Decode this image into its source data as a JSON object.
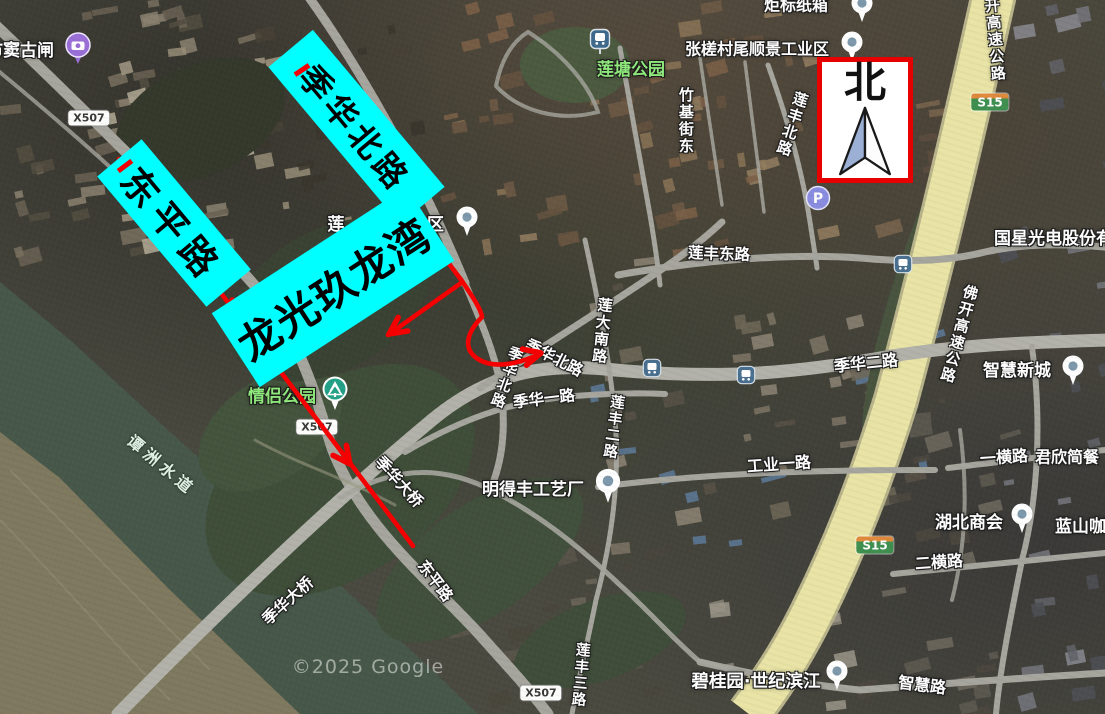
{
  "colors": {
    "annotation_cyan": "#00ffff",
    "annotation_red": "#f40000",
    "north_border_red": "#e60000",
    "highway_yellow": "#e9e4a6",
    "road_gray": "#a6a69e",
    "river_green": "#47584a",
    "park_label_green": "#8fe97c",
    "s15_badge_green": "#3f9050",
    "s15_badge_orange": "#e08a3c"
  },
  "north_box": {
    "label": "北"
  },
  "annotations": {
    "boxes": [
      {
        "id": "dongping-road-callout",
        "text": "东平路",
        "x": 174,
        "y": 223,
        "w": 170,
        "h": 58,
        "r": 50,
        "fs": 37,
        "ls": 8
      },
      {
        "id": "jihua-north-road-callout",
        "text": "季华北路",
        "x": 356,
        "y": 127,
        "w": 205,
        "h": 58,
        "r": 50,
        "fs": 33,
        "ls": 5
      },
      {
        "id": "longguang-jiulongwan-callout",
        "text": "龙光玖龙湾",
        "x": 333,
        "y": 287,
        "w": 232,
        "h": 88,
        "r": -33,
        "fs": 42,
        "ls": 2
      }
    ]
  },
  "red": {
    "paths": [
      "M 119 159 L 413 546",
      "M 297 62 L 462 281 C 472 296 481 309 482 317 C 467 332 462 349 478 359 C 492 368 513 365 533 357 L 541 353",
      "M 461 283 L 388 335"
    ],
    "arrows": [
      {
        "x": 232,
        "y": 300,
        "a": -127
      },
      {
        "x": 350,
        "y": 464,
        "a": 53
      },
      {
        "x": 404,
        "y": 198,
        "a": 56
      },
      {
        "x": 541,
        "y": 353,
        "a": -14
      },
      {
        "x": 389,
        "y": 334,
        "a": 145
      }
    ],
    "ticks": [
      {
        "x": 125,
        "y": 166,
        "r": 53
      },
      {
        "x": 302,
        "y": 70,
        "r": 56
      }
    ]
  },
  "map": {
    "labels": [
      {
        "id": "shuidou-sluice",
        "t": "市窦古闸",
        "x": 20,
        "y": 52,
        "fs": 17,
        "cls": "place"
      },
      {
        "id": "liantang-park",
        "t": "莲塘公园",
        "x": 631,
        "y": 71,
        "fs": 17,
        "cls": "park"
      },
      {
        "id": "zhangcha-shunjing-industrial-zone",
        "t": "张槎村尾顺景工业区",
        "x": 757,
        "y": 50,
        "fs": 16,
        "cls": "place"
      },
      {
        "id": "jubiao-paper-box",
        "t": "炬标纸箱",
        "x": 796,
        "y": 6,
        "fs": 16,
        "cls": "place"
      },
      {
        "id": "zhuji-street-east",
        "t": "竹基街东",
        "x": 685,
        "y": 121,
        "fs": 15,
        "cls": "road",
        "v": 1
      },
      {
        "id": "lianfeng-north-road",
        "t": "莲丰北路",
        "x": 791,
        "y": 124,
        "fs": 15,
        "cls": "road",
        "v": 1,
        "r": 18
      },
      {
        "id": "kai-expressway",
        "t": "开高速公路",
        "x": 994,
        "y": 40,
        "fs": 15,
        "cls": "road",
        "v": 1,
        "r": -5
      },
      {
        "id": "lianfeng-east-road",
        "t": "莲丰东路",
        "x": 719,
        "y": 254,
        "fs": 15.5,
        "cls": "road",
        "r": 2
      },
      {
        "id": "guoxing-optoelectronics",
        "t": "国星光电股份有限",
        "x": 1062,
        "y": 240,
        "fs": 17,
        "cls": "place"
      },
      {
        "id": "fokai-expressway",
        "t": "佛开高速公路",
        "x": 958,
        "y": 334,
        "fs": 15,
        "cls": "road",
        "v": 1,
        "r": 15
      },
      {
        "id": "lianda-south-road",
        "t": "莲大南路",
        "x": 601,
        "y": 331,
        "fs": 15,
        "cls": "road",
        "v": 1,
        "r": 6
      },
      {
        "id": "lian-fragment",
        "t": "莲",
        "x": 336,
        "y": 226,
        "fs": 17,
        "cls": "place"
      },
      {
        "id": "industrial-dev-zone-fragment",
        "t": "业开发区",
        "x": 410,
        "y": 226,
        "fs": 17,
        "cls": "place"
      },
      {
        "id": "jihua-north-road-ne",
        "t": "季华北路",
        "x": 554,
        "y": 358,
        "fs": 15.5,
        "cls": "road",
        "r": 27
      },
      {
        "id": "jihua-north-road-s",
        "t": "季华北路",
        "x": 505,
        "y": 377,
        "fs": 14.5,
        "cls": "road",
        "v": 1,
        "r": 20
      },
      {
        "id": "jihua-1st-road",
        "t": "季华一路",
        "x": 544,
        "y": 399,
        "fs": 15.5,
        "cls": "road",
        "r": -7
      },
      {
        "id": "lianfeng-2nd-road",
        "t": "莲丰二路",
        "x": 612,
        "y": 427,
        "fs": 14.5,
        "cls": "road",
        "v": 1,
        "r": 8
      },
      {
        "id": "jihua-2nd-road",
        "t": "季华二路",
        "x": 866,
        "y": 364,
        "fs": 16,
        "cls": "road",
        "r": -6
      },
      {
        "id": "gongye-1st-road",
        "t": "工业一路",
        "x": 779,
        "y": 465,
        "fs": 16,
        "cls": "road",
        "r": -4
      },
      {
        "id": "mingdefeng-craft-factory",
        "t": "明得丰工艺厂",
        "x": 533,
        "y": 491,
        "fs": 17,
        "cls": "place"
      },
      {
        "id": "zhihui-new-town",
        "t": "智慧新城",
        "x": 1017,
        "y": 372,
        "fs": 17,
        "cls": "place"
      },
      {
        "id": "yiheng-road",
        "t": "一横路",
        "x": 1004,
        "y": 458,
        "fs": 16,
        "cls": "road",
        "r": -4
      },
      {
        "id": "junxin-restaurant",
        "t": "君欣简餐",
        "x": 1067,
        "y": 458,
        "fs": 16,
        "cls": "place"
      },
      {
        "id": "hubei-chamber-of-commerce",
        "t": "湖北商会",
        "x": 969,
        "y": 524,
        "fs": 17,
        "cls": "place"
      },
      {
        "id": "lanshan-coffee",
        "t": "蓝山咖啡",
        "x": 1089,
        "y": 528,
        "fs": 17,
        "cls": "place"
      },
      {
        "id": "erheng-road",
        "t": "二横路",
        "x": 939,
        "y": 563,
        "fs": 16,
        "cls": "road",
        "r": -4
      },
      {
        "id": "zhihui-road",
        "t": "智慧路",
        "x": 922,
        "y": 686,
        "fs": 16,
        "cls": "road",
        "r": 7
      },
      {
        "id": "biguiyuan-century-riverside",
        "t": "碧桂园·世纪滨江",
        "x": 756,
        "y": 682,
        "fs": 17.5,
        "cls": "place"
      },
      {
        "id": "lianfeng-3rd-road",
        "t": "莲丰三路",
        "x": 579,
        "y": 675,
        "fs": 14.5,
        "cls": "road",
        "v": 1,
        "r": 5
      },
      {
        "id": "dongping-road",
        "t": "东平路",
        "x": 435,
        "y": 581,
        "fs": 15.5,
        "cls": "road",
        "r": 53
      },
      {
        "id": "jihua-bridge-upper",
        "t": "季华大桥",
        "x": 399,
        "y": 482,
        "fs": 15.5,
        "cls": "road",
        "r": 48
      },
      {
        "id": "jihua-bridge-lower",
        "t": "季华大桥",
        "x": 288,
        "y": 601,
        "fs": 15.5,
        "cls": "road",
        "r": -42
      },
      {
        "id": "tanzhou-waterway",
        "t": "谭洲水道",
        "x": 161,
        "y": 466,
        "fs": 16,
        "cls": "water",
        "r": 40
      },
      {
        "id": "qinglv-park",
        "t": "情侣公园",
        "x": 282,
        "y": 398,
        "fs": 17,
        "cls": "park"
      },
      {
        "id": "google-watermark",
        "t": "©2025 Google",
        "x": 368,
        "y": 668,
        "fs": 19,
        "cls": "wm"
      }
    ],
    "badges": [
      {
        "k": "x507",
        "t": "X507",
        "x": 89,
        "y": 118
      },
      {
        "k": "x507",
        "t": "X507",
        "x": 317,
        "y": 427
      },
      {
        "k": "x507",
        "t": "X507",
        "x": 541,
        "y": 693
      },
      {
        "k": "s15",
        "t": "S15",
        "x": 990,
        "y": 102
      },
      {
        "k": "s15",
        "t": "S15",
        "x": 875,
        "y": 545
      }
    ],
    "markers": [
      {
        "k": "camera",
        "x": 78,
        "y": 51
      },
      {
        "k": "metro",
        "x": 600,
        "y": 44
      },
      {
        "k": "pin",
        "x": 862,
        "y": 10
      },
      {
        "k": "pin",
        "x": 852,
        "y": 49
      },
      {
        "k": "pin",
        "x": 467,
        "y": 224
      },
      {
        "k": "pin",
        "x": 1073,
        "y": 373
      },
      {
        "k": "pin",
        "x": 1022,
        "y": 521
      },
      {
        "k": "pin",
        "x": 837,
        "y": 678
      },
      {
        "k": "pin",
        "x": 608,
        "y": 489,
        "s": 1.15
      },
      {
        "k": "bus",
        "x": 652,
        "y": 370
      },
      {
        "k": "bus",
        "x": 746,
        "y": 377
      },
      {
        "k": "bus",
        "x": 903,
        "y": 266
      },
      {
        "k": "p",
        "x": 818,
        "y": 200
      },
      {
        "k": "tree",
        "x": 335,
        "y": 396
      }
    ]
  }
}
